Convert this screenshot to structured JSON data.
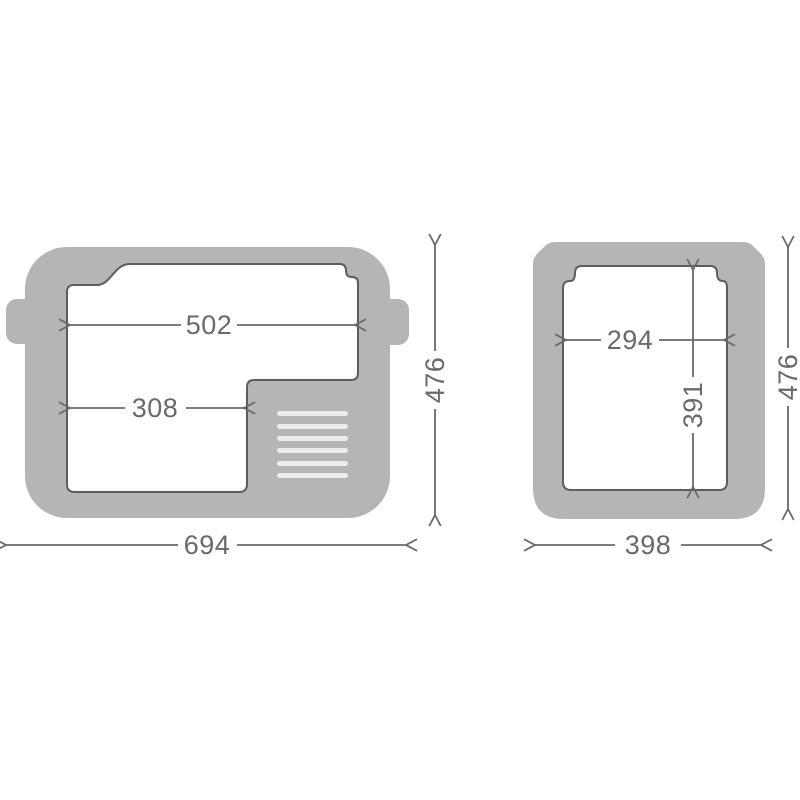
{
  "diagram": {
    "kind": "technical-dimension-drawing",
    "front_view": {
      "inner_width_top": "502",
      "inner_width_bottom": "308",
      "overall_width": "694",
      "overall_height": "476",
      "vent_slat_count": 6
    },
    "side_view": {
      "inner_width": "294",
      "inner_height": "391",
      "overall_width": "398",
      "overall_height": "476"
    }
  },
  "colors": {
    "body_gray": "#b5b5b5",
    "outline_gray": "#5d5d5f",
    "dimension_gray": "#6a6a6a",
    "vent_light": "#ececec",
    "background": "#ffffff"
  }
}
